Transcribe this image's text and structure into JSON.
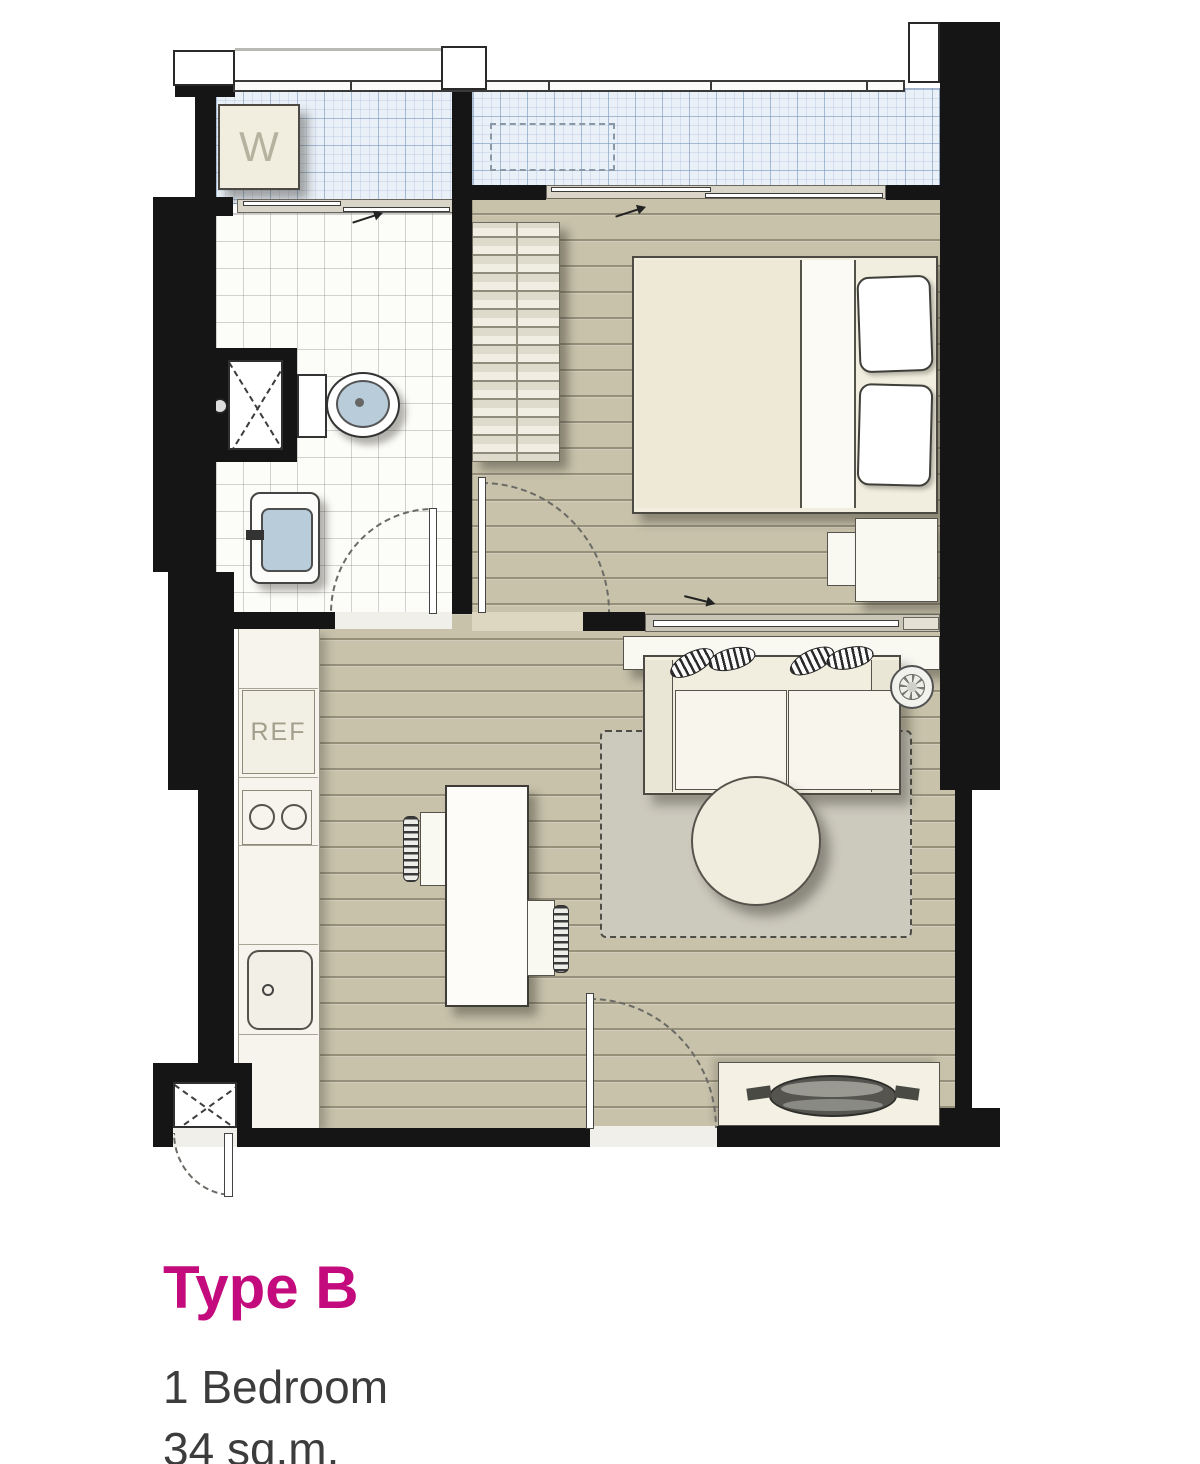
{
  "title_block": {
    "title": "Type B",
    "bedrooms": "1 Bedroom",
    "area": "34 sq.m."
  },
  "legend": {
    "washer_label": "W",
    "refrigerator_label": "REF"
  },
  "colors": {
    "accent_magenta": "#c30b7e",
    "text_gray": "#3c3c3c",
    "wall_black": "#151515",
    "wood_floor": "#c8c2ab",
    "balcony_tile": "#e9f0f7",
    "bathroom_tile": "#fcfcf9",
    "furniture_cream": "#f1eedf",
    "fixture_blue": "#b9ccd9",
    "rug_gray": "#ccc9bd"
  },
  "symbols": {
    "washer": "square box with W letter on laundry balcony",
    "toilet": "tank and oval blue bowl",
    "washbasin": "rounded rect with blue basin and faucet",
    "shower_mixer": "small lever on bathroom wall",
    "duct_shaft": "white box with dashed X (two places)",
    "wardrobe": "hatched bar closet in bedroom",
    "double_bed": "mattress with two pillows and side sheet band",
    "nightstand": "two small boxes beside bed",
    "sofa": "two-seat sofa with striped leaf cushions",
    "fan": "small spoked circle beside sofa",
    "coffee_table": "round table on dashed rug",
    "dining_table": "rectangular table with two striped-back chairs",
    "tv_console": "low cabinet with dark oval dish near entrance",
    "refrigerator": "counter box labeled REF",
    "stove": "two burner circles",
    "kitchen_sink": "rounded square with drain",
    "swing_doors": "four dashed quarter-circle arcs",
    "sliding_doors": "three rail tracks with panels and direction arrows"
  }
}
